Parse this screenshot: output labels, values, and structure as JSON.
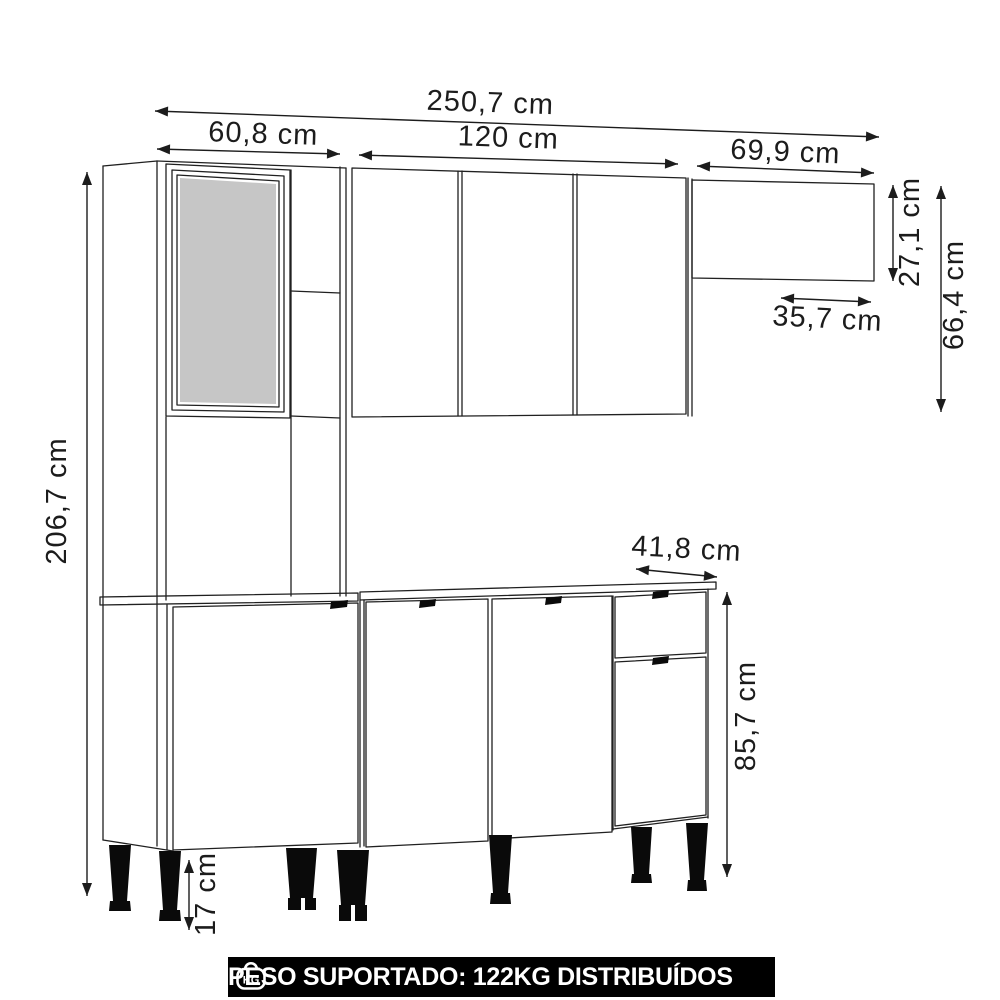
{
  "diagram": {
    "type": "kitchen-cabinet-dimension-drawing",
    "dimensions": {
      "total_width": "250,7 cm",
      "left_section_width": "60,8 cm",
      "wall_cabinet_width": "120 cm",
      "right_shelf_width": "69,9 cm",
      "right_shelf_height": "27,1 cm",
      "upper_section_height": "66,4 cm",
      "right_shelf_depth": "35,7 cm",
      "total_height": "206,7 cm",
      "base_unit_width": "41,8 cm",
      "base_height": "85,7 cm",
      "leg_height": "17 cm"
    },
    "colors": {
      "background": "#ffffff",
      "line": "#202020",
      "glass_fill": "#c6c6c6",
      "legs": "#0a0a0a",
      "banner_bg": "#000000",
      "banner_text": "#ffffff"
    }
  },
  "banner": {
    "icon_label": "KG",
    "text": "PESO SUPORTADO: 122KG DISTRIBUÍDOS"
  }
}
